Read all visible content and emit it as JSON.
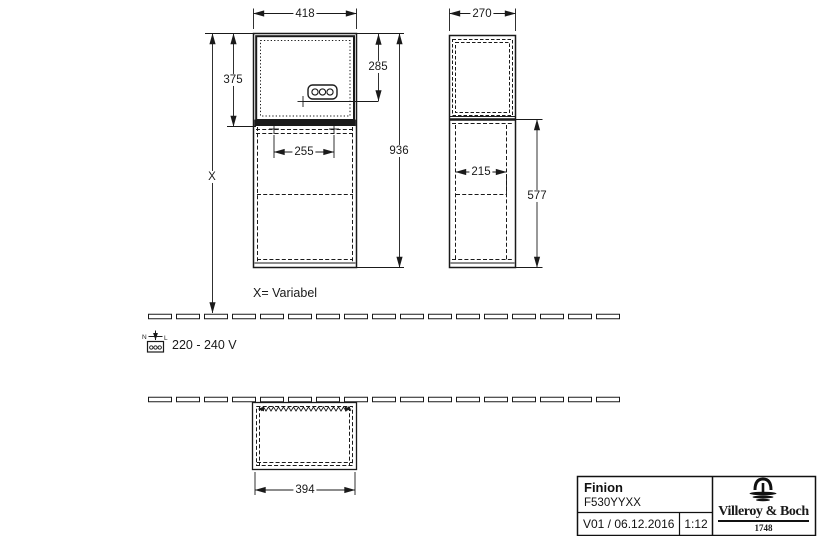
{
  "drawing": {
    "front_view": {
      "width_dim": "418",
      "upper_compartment_height_dim": "375",
      "socket_height_dim": "285",
      "mount_spacing_dim": "255",
      "total_height_dim": "936",
      "variable_height_dim": "X"
    },
    "side_view": {
      "depth_dim": "270",
      "inner_depth_dim": "215",
      "lower_section_height_dim": "577"
    },
    "plan_view": {
      "width_dim": "394"
    },
    "notes": {
      "variable_note": "X= Variabel",
      "voltage_note": "220 - 240 V"
    },
    "power_icon": {
      "n_label": "N",
      "l_label": "L"
    }
  },
  "title_block": {
    "product_name": "Finion",
    "article_number": "F530YYXX",
    "version_date": "V01 / 06.12.2016",
    "scale": "1:12",
    "brand_name": "Villeroy & Boch",
    "brand_year": "1748"
  },
  "colors": {
    "line": "#1a1a1a",
    "background": "#ffffff"
  }
}
